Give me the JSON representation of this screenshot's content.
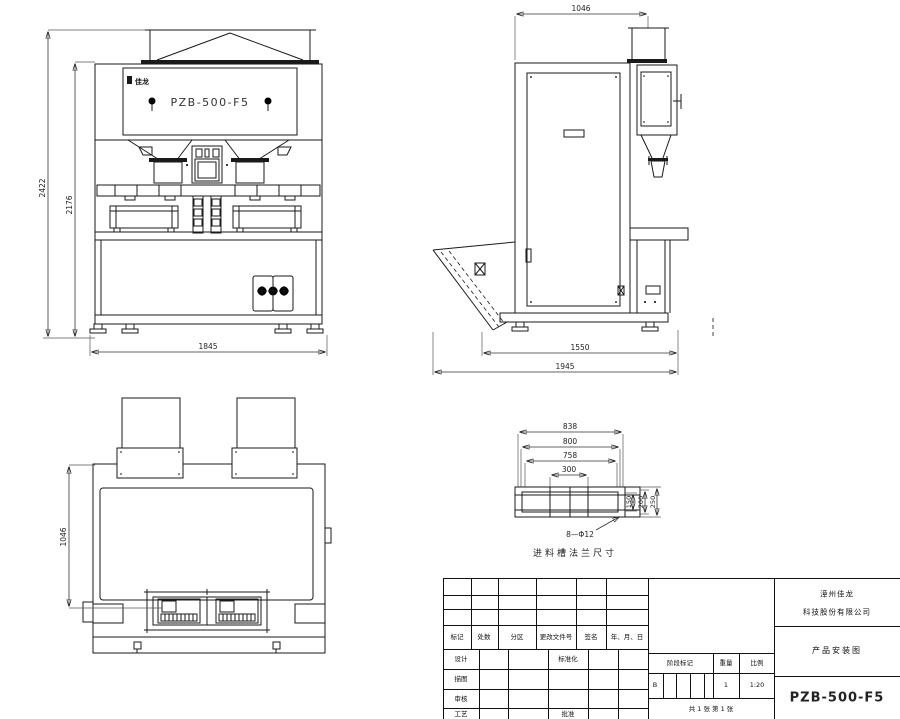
{
  "drawing": {
    "model": "PZB-500-F5",
    "logo": "佳龙",
    "views": {
      "front": {
        "dims": {
          "h1": "2422",
          "h2": "2176",
          "w": "1845"
        }
      },
      "side": {
        "dims": {
          "top": "1046",
          "d1": "1550",
          "d2": "1945"
        }
      },
      "top": {
        "dims": {
          "depth": "1046"
        }
      },
      "flange": {
        "dims": {
          "w1": "838",
          "w2": "800",
          "w3": "758",
          "w4": "300",
          "hh1": "150",
          "hh2": "200",
          "hh3": "250"
        },
        "holes": "8—Φ12",
        "caption": "进料槽法兰尺寸"
      }
    },
    "title_block": {
      "company_line1": "漳州佳龙",
      "company_line2": "科技股份有限公司",
      "drawing_title": "产品安装图",
      "drawing_number": "PZB-500-F5",
      "header_labels": [
        "标记",
        "处数",
        "分区",
        "更改文件号",
        "签名",
        "年、月、日"
      ],
      "row_labels": [
        "设计",
        "描图",
        "审核",
        "工艺"
      ],
      "mid_label_top": "标准化",
      "mid_label_bottom": "批准",
      "stage_label": "阶段标记",
      "weight_label": "重量",
      "scale_label": "比例",
      "stage_value": "B",
      "weight_value": "1",
      "scale_value": "1:20",
      "sheet_info": "共 1 张  第 1 张"
    }
  }
}
